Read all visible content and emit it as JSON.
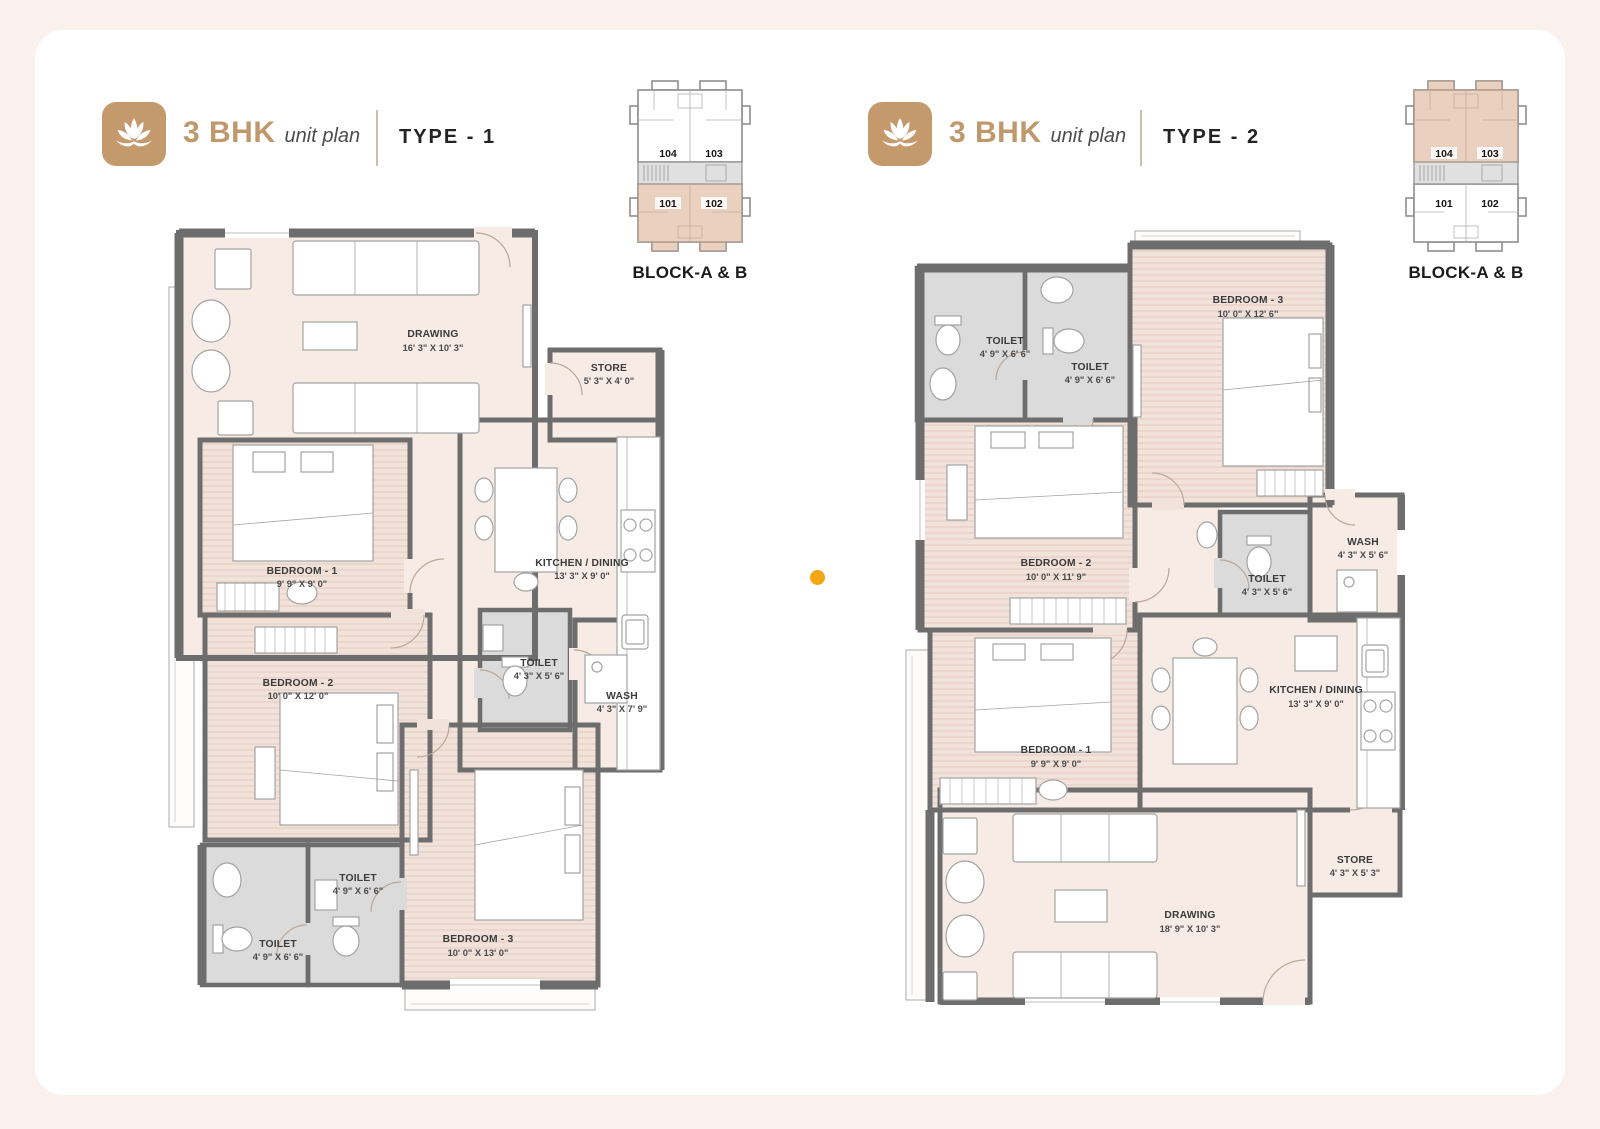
{
  "page": {
    "watermark_letter": "A"
  },
  "panels": [
    {
      "brand": "3 BHK",
      "brand_sub": "unit plan",
      "type_label": "TYPE - 1",
      "block_prefix": "BLOCK-",
      "block_bold": "A & B",
      "keyplan_units": {
        "top_left": "104",
        "top_right": "103",
        "bottom_left": "101",
        "bottom_right": "102"
      },
      "rooms": [
        {
          "name": "DRAWING",
          "dims": "16' 3\" X 10' 3\""
        },
        {
          "name": "STORE",
          "dims": "5' 3\" X 4' 0\""
        },
        {
          "name": "BEDROOM - 1",
          "dims": "9' 9\" X 9' 0\""
        },
        {
          "name": "KITCHEN / DINING",
          "dims": "13' 3\" X 9' 0\""
        },
        {
          "name": "BEDROOM - 2",
          "dims": "10' 0\" X 12' 0\""
        },
        {
          "name": "TOILET",
          "dims": "4' 3\" X 5' 6\""
        },
        {
          "name": "WASH",
          "dims": "4' 3\" X 7' 9\""
        },
        {
          "name": "TOILET",
          "dims": "4' 9\" X 6' 6\""
        },
        {
          "name": "TOILET",
          "dims": "4' 9\" X 6' 6\""
        },
        {
          "name": "BEDROOM - 3",
          "dims": "10' 0\" X 13' 0\""
        }
      ]
    },
    {
      "brand": "3 BHK",
      "brand_sub": "unit plan",
      "type_label": "TYPE - 2",
      "block_prefix": "BLOCK-",
      "block_bold": "A & B",
      "keyplan_units": {
        "top_left": "104",
        "top_right": "103",
        "bottom_left": "101",
        "bottom_right": "102"
      },
      "rooms": [
        {
          "name": "TOILET",
          "dims": "4' 9\" X 6' 6\""
        },
        {
          "name": "TOILET",
          "dims": "4' 9\" X 6' 6\""
        },
        {
          "name": "BEDROOM - 3",
          "dims": "10' 0\" X 12' 6\""
        },
        {
          "name": "BEDROOM - 2",
          "dims": "10' 0\" X 11' 9\""
        },
        {
          "name": "TOILET",
          "dims": "4' 3\" X 5' 6\""
        },
        {
          "name": "WASH",
          "dims": "4' 3\" X 5' 6\""
        },
        {
          "name": "BEDROOM - 1",
          "dims": "9' 9\" X 9' 0\""
        },
        {
          "name": "KITCHEN / DINING",
          "dims": "13' 3\" X 9' 0\""
        },
        {
          "name": "STORE",
          "dims": "4' 3\" X 5' 3\""
        },
        {
          "name": "DRAWING",
          "dims": "18' 9\" X 10' 3\""
        }
      ]
    }
  ]
}
